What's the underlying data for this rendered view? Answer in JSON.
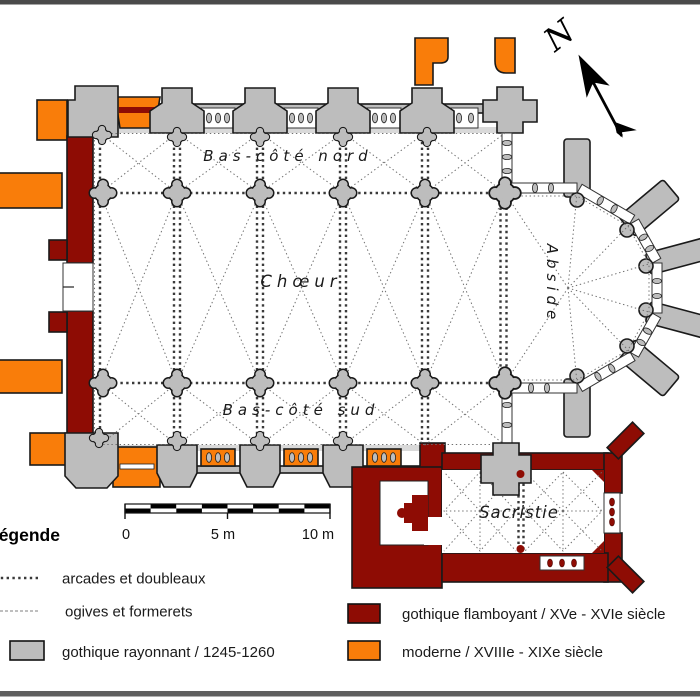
{
  "plan": {
    "labels": {
      "north_aisle": "Bas-côté nord",
      "choir": "Chœur",
      "south_aisle": "Bas-côté sud",
      "apse": "Abside",
      "sacristy": "Sacristie"
    },
    "north_letter": "N"
  },
  "scale_bar": {
    "tick_0": "0",
    "tick_5": "5 m",
    "tick_10": "10 m"
  },
  "legend": {
    "title": "Légende",
    "items": [
      {
        "label": "arcades et doubleaux",
        "swatch": "dotted-line"
      },
      {
        "label": "ogives et formerets",
        "swatch": "thin-line"
      },
      {
        "label": "gothique rayonnant / 1245-1260",
        "swatch": "filled-box",
        "color": "#bdbdbd"
      },
      {
        "label": "gothique flamboyant / XVe - XVIe siècle",
        "swatch": "filled-box",
        "color": "#8e0c04"
      },
      {
        "label": "moderne / XVIIIe - XIXe siècle",
        "swatch": "filled-box",
        "color": "#f97d0a"
      }
    ]
  },
  "colors": {
    "gothique_rayonnant": "#bdbdbd",
    "gothique_flamboyant": "#8e0c04",
    "moderne": "#f97d0a",
    "outline": "#1a1a1a"
  }
}
